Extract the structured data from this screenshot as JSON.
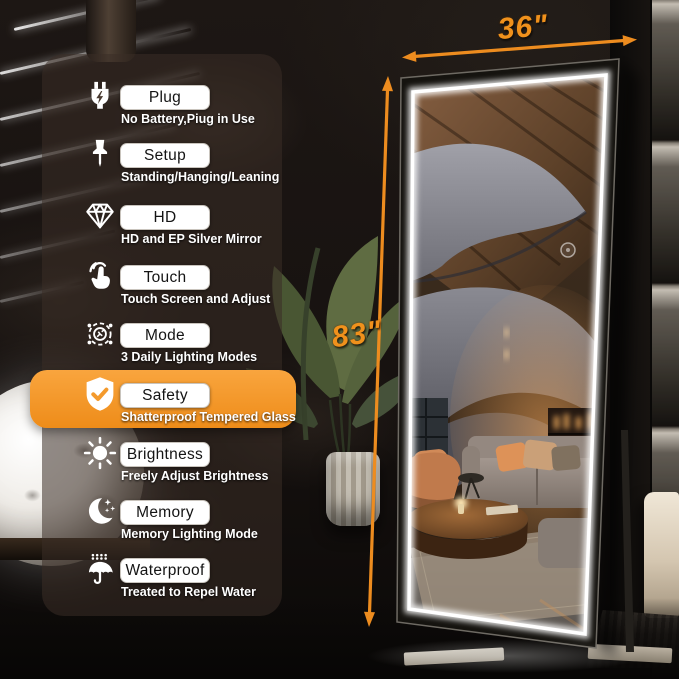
{
  "annotations": {
    "width_label": "36\"",
    "height_label": "83\""
  },
  "features": [
    {
      "icon": "plug-icon",
      "label": "Plug",
      "subtitle": "No Battery,Piug in Use",
      "highlighted": false
    },
    {
      "icon": "pushpin-icon",
      "label": "Setup",
      "subtitle": "Standing/Hanging/Leaning",
      "highlighted": false
    },
    {
      "icon": "diamond-icon",
      "label": "HD",
      "subtitle": "HD and EP Silver Mirror",
      "highlighted": false
    },
    {
      "icon": "touch-icon",
      "label": "Touch",
      "subtitle": "Touch Screen and Adjust",
      "highlighted": false
    },
    {
      "icon": "fan-mode-icon",
      "label": "Mode",
      "subtitle": "3 Daily Lighting Modes",
      "highlighted": false
    },
    {
      "icon": "shield-check-icon",
      "label": "Safety",
      "subtitle": "Shatterproof Tempered Glass",
      "highlighted": true
    },
    {
      "icon": "sun-icon",
      "label": "Brightness",
      "subtitle": "Freely Adjust Brightness",
      "highlighted": false
    },
    {
      "icon": "moon-stars-icon",
      "label": "Memory",
      "subtitle": "Memory Lighting Mode",
      "highlighted": false
    },
    {
      "icon": "umbrella-rain-icon",
      "label": "Waterproof",
      "subtitle": "Treated to Repel Water",
      "highlighted": false
    }
  ],
  "colors": {
    "accent_orange": "#F0911C",
    "highlight_band": "#F49A2C",
    "led_white": "#FFFFFF",
    "pill_background": "#FFFFFF",
    "pill_text": "#141414",
    "subtitle_text": "#FFFFFF"
  }
}
